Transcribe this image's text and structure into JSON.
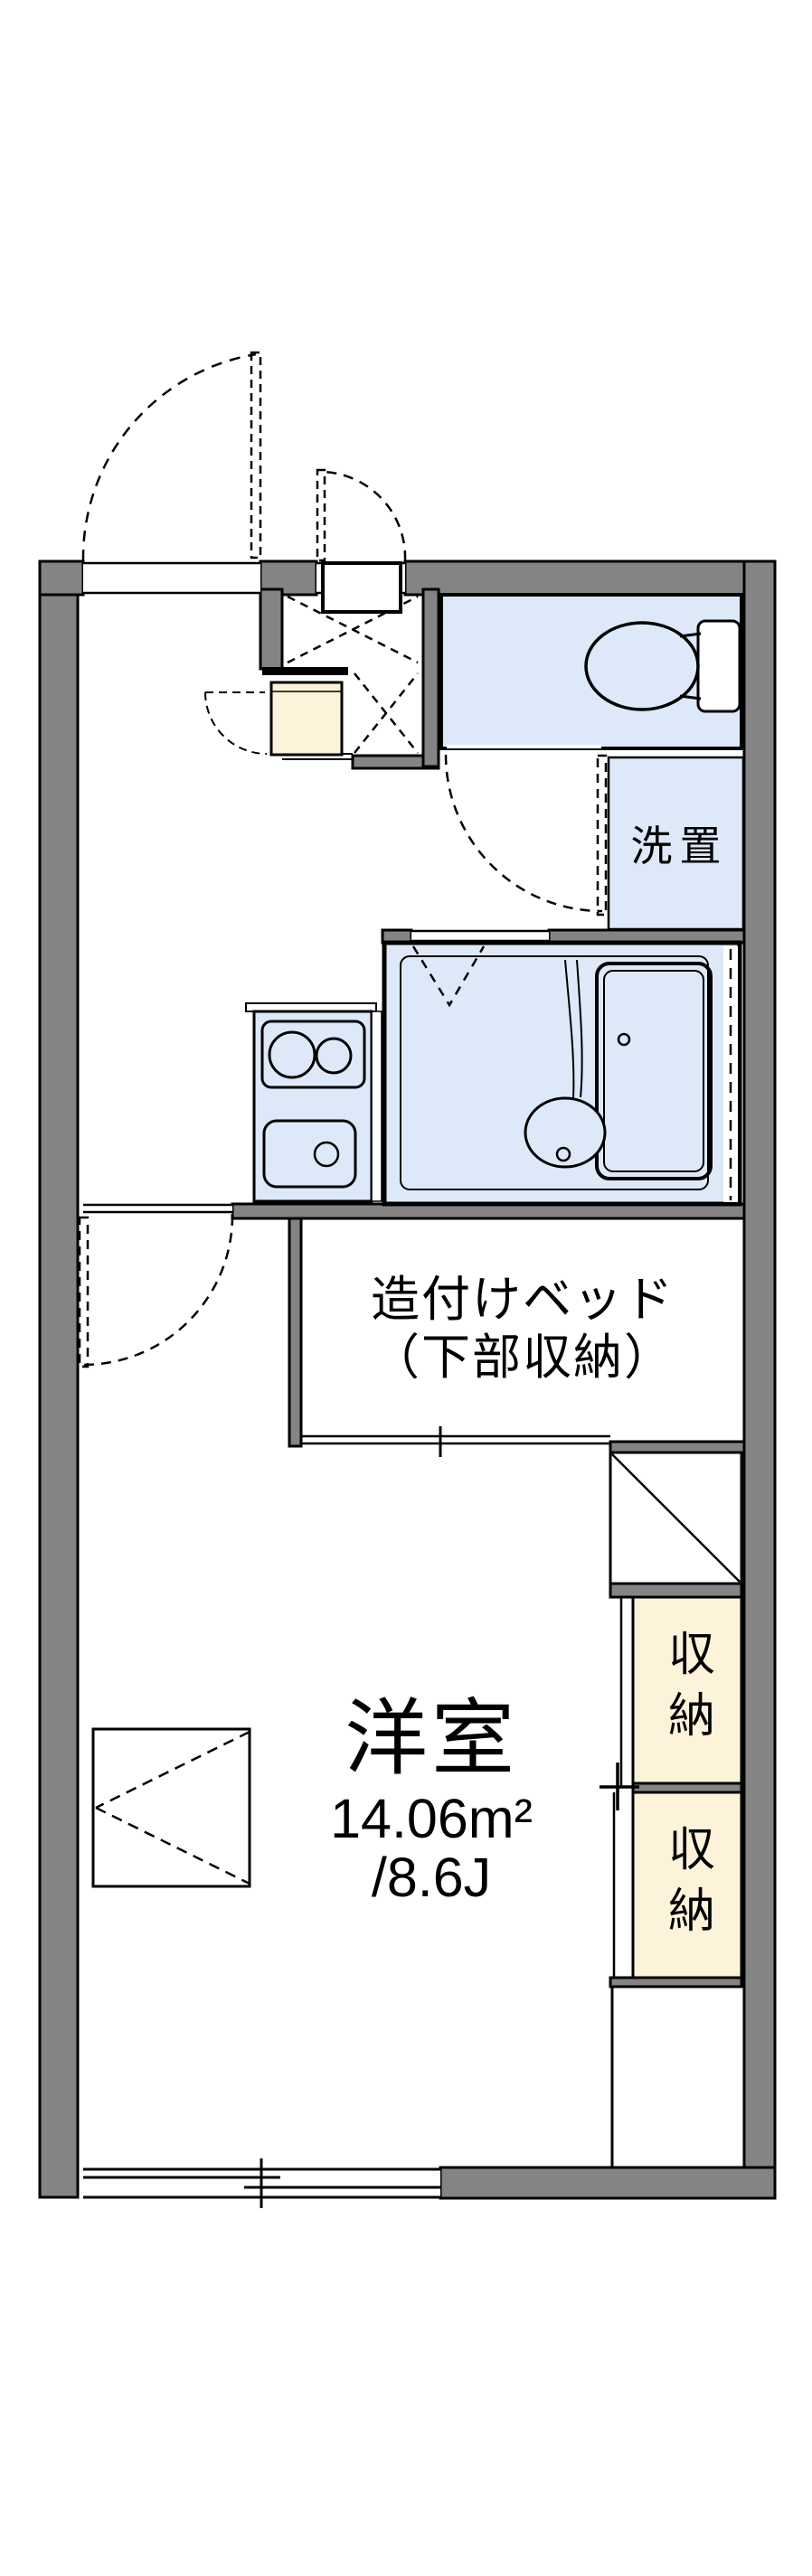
{
  "floorplan": {
    "colors": {
      "wall_gray": "#848484",
      "wet_area_blue": "#dde9f8",
      "storage_cream": "#fdf3da",
      "line_black": "#000000"
    },
    "rooms": {
      "western_room": {
        "name": "洋室",
        "area_m2": "14.06m²",
        "area_jo": "/8.6J"
      },
      "built_in_bed": {
        "label_line1": "造付けベッド",
        "label_line2": "（下部収納）"
      },
      "washer_space": {
        "label": "洗置"
      },
      "closets": [
        {
          "label": "収納"
        },
        {
          "label": "収納"
        }
      ]
    }
  }
}
